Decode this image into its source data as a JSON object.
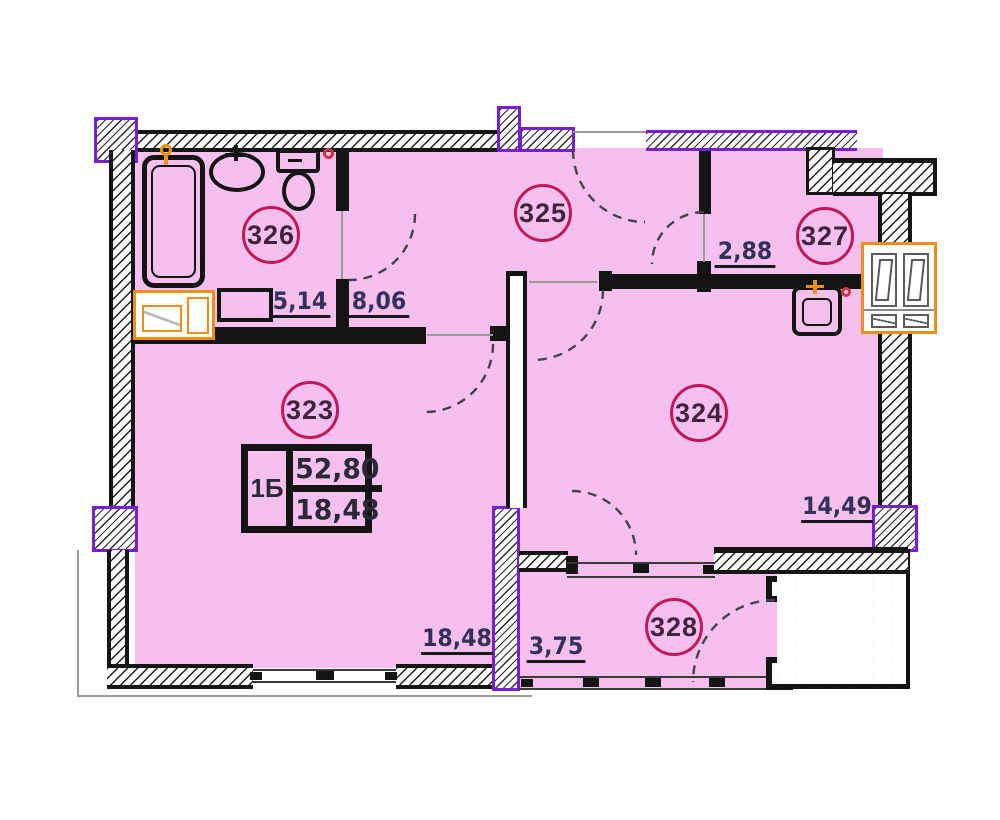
{
  "labels": {
    "room_323": "323",
    "room_324": "324",
    "room_325": "325",
    "room_326": "326",
    "room_327": "327",
    "room_328": "328"
  },
  "dimensions": {
    "bathroom_width": "5,14",
    "hallway_width": "8,06",
    "kitchen_width": "2,88",
    "bedroom_width": "14,49",
    "living_width": "18,48",
    "balcony_width": "3,75"
  },
  "info_box": {
    "unit_type": "1Б",
    "total_area": "52,80",
    "living_area": "18,48"
  },
  "colors": {
    "room_fill": "#f6c0ee",
    "wall": "#141414",
    "accent_purple": "#7a1ed2",
    "accent_orange": "#ee9018",
    "circle_stroke": "#c2175b",
    "dim_text": "#33305a"
  }
}
